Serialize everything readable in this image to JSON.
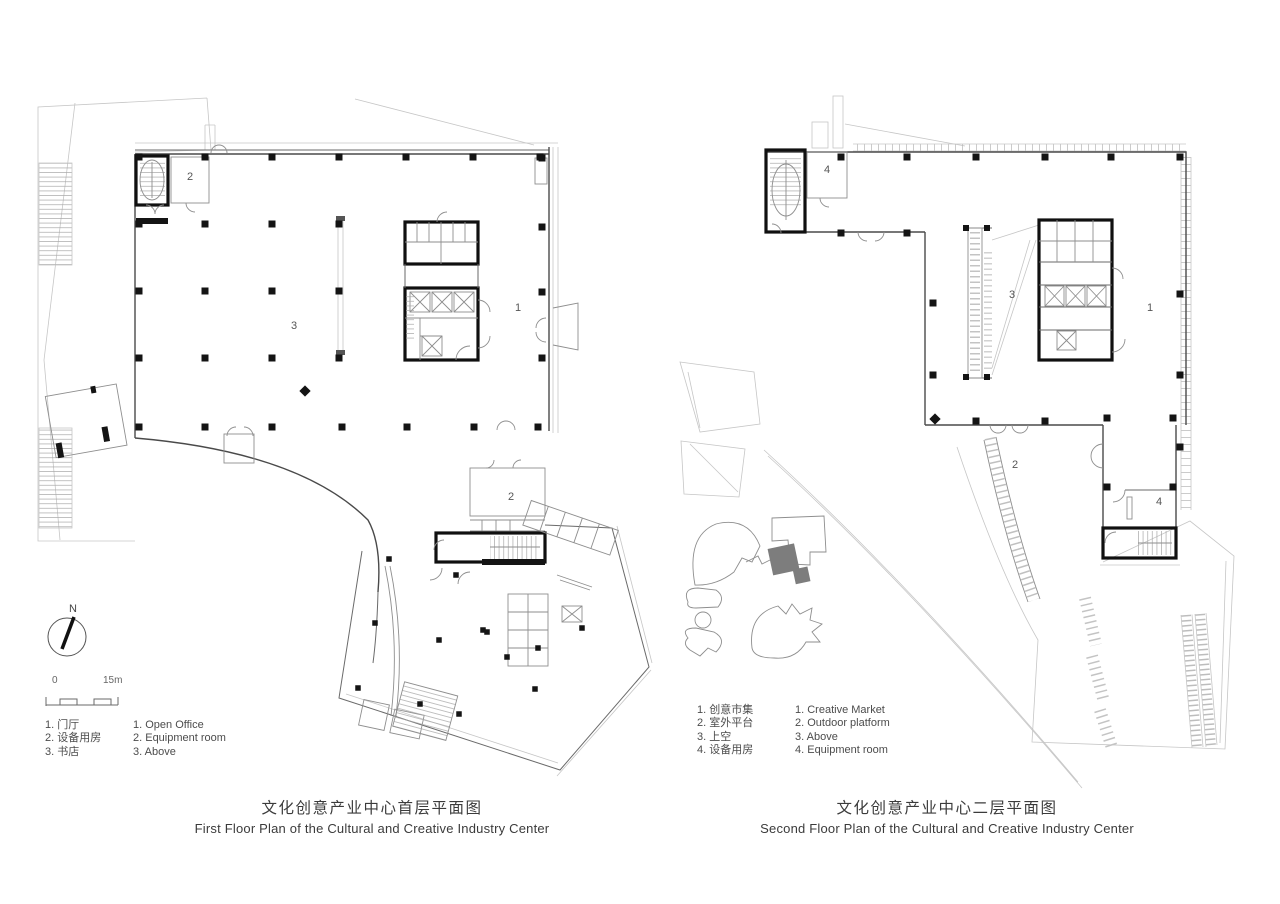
{
  "page": {
    "background": "#ffffff"
  },
  "compass": {
    "north_label": "N"
  },
  "scale_bar": {
    "start_label": "0",
    "end_label": "15m"
  },
  "left_plan": {
    "title_zh": "文化创意产业中心首层平面图",
    "title_en": "First Floor Plan of the Cultural and Creative Industry Center",
    "room_labels": [
      "2",
      "3",
      "1",
      "2"
    ],
    "legend_zh": [
      "1. 门厅",
      "2. 设备用房",
      "3. 书店"
    ],
    "legend_en": [
      "1. Open Office",
      "2. Equipment room",
      "3. Above"
    ]
  },
  "right_plan": {
    "title_zh": "文化创意产业中心二层平面图",
    "title_en": "Second Floor Plan of the Cultural and Creative Industry Center",
    "room_labels": [
      "4",
      "3",
      "1",
      "2",
      "4"
    ],
    "legend_zh": [
      "1. 创意市集",
      "2. 室外平台",
      "3. 上空",
      "4. 设备用房"
    ],
    "legend_en": [
      "1. Creative Market",
      "2. Outdoor platform",
      "3. Above",
      "4. Equipment room"
    ]
  },
  "colors": {
    "wall_dark": "#111111",
    "wall_mid": "#4a4a4a",
    "line_light": "#c6c6c6",
    "highlight_fill": "#7d7d7d",
    "text": "#4c4c4c"
  }
}
